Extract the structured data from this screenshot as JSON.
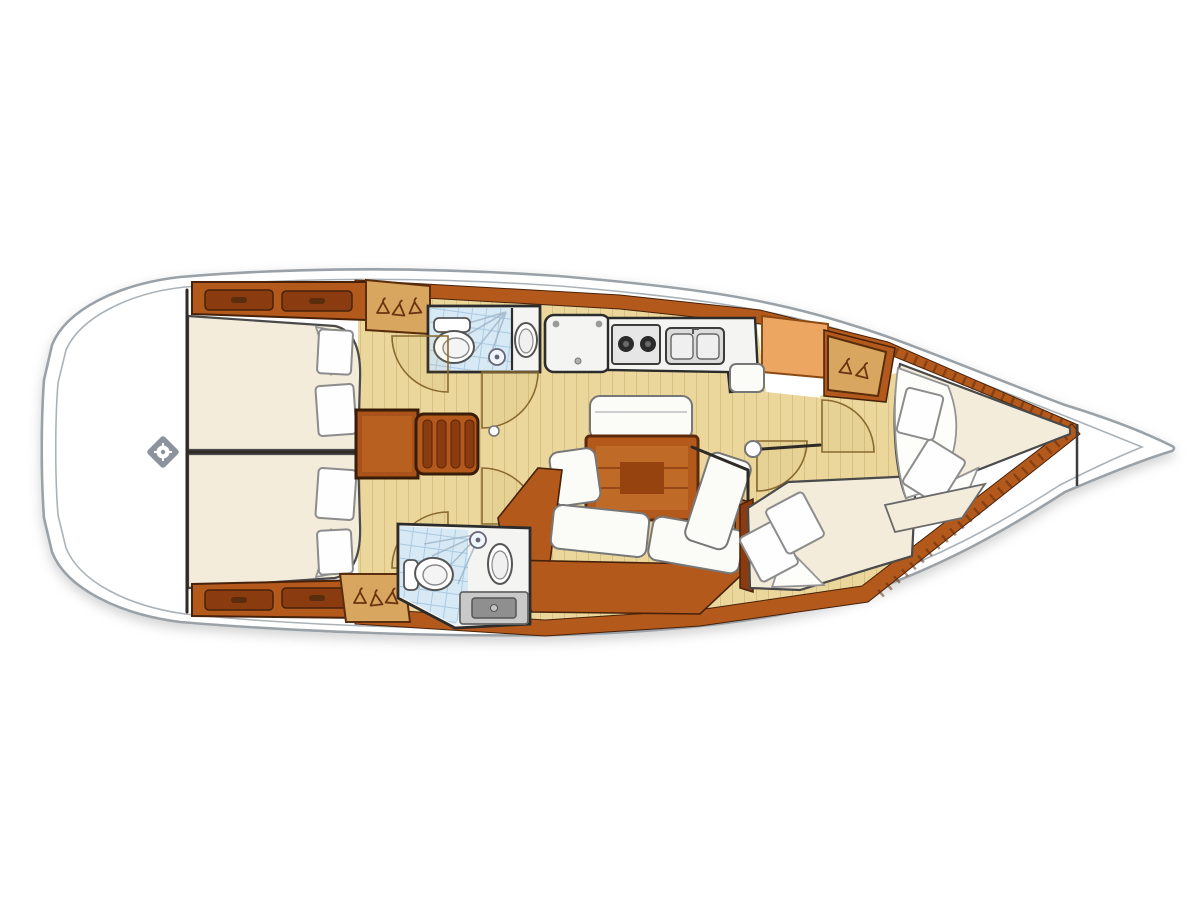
{
  "diagram": {
    "kind": "sailing-yacht-interior-floor-plan",
    "orientation": "bow-right-stern-left",
    "areas": {
      "stern_deck": "stern-deck-with-helm",
      "aft_cabin_port": "aft-double-cabin-port",
      "aft_cabin_starboard": "aft-double-cabin-starboard",
      "head_port": "head-with-shower-and-toilet-port",
      "head_aft": "head-with-shower-and-toilet-starboard",
      "galley": "galley-with-stove-and-double-sink",
      "companionway": "companionway-steps",
      "saloon": "saloon-with-table-and-sofa",
      "cabin_mid_starboard": "double-cabin-starboard-forward",
      "forward_cabin": "forward-v-berth-cabin",
      "bow_deck": "bow-deck"
    },
    "feature_counts": {
      "cabins": 4,
      "beds": 4,
      "heads": 2,
      "hanging_lockers": 3,
      "pillows": 8,
      "door_arcs": 6,
      "stove_burners": 2,
      "sinks_galley": 2
    }
  },
  "icons": [
    "helm-icon",
    "hanger-icon",
    "toilet-icon",
    "sink-icon",
    "shower-icon",
    "stove-icon",
    "double-sink-icon",
    "steps-icon",
    "drawer-icon"
  ],
  "palette": {
    "hull-stroke": "#9aa1a7",
    "deck": "#ffffff",
    "wood": "#b4591c",
    "wood-dark": "#8a3c10",
    "wood-outline": "#47220a",
    "floor": "#ebd79c",
    "floor-line": "#c9ab62",
    "bed": "#f3ecdb",
    "cushion": "#fbfbf7",
    "pillow": "#fefefe",
    "pillow-stroke": "#8c8c8c",
    "tile": "#d6e9f5",
    "tile-line": "#a9c9e2",
    "cabinet-orange": "#eda661",
    "locker-tan": "#d8a65f",
    "hanger": "#6b3310",
    "counter": "#f4f4f2",
    "steel": "#c9c9c9",
    "steel-dark": "#8f8f8f",
    "wall": "#2e2a26"
  }
}
